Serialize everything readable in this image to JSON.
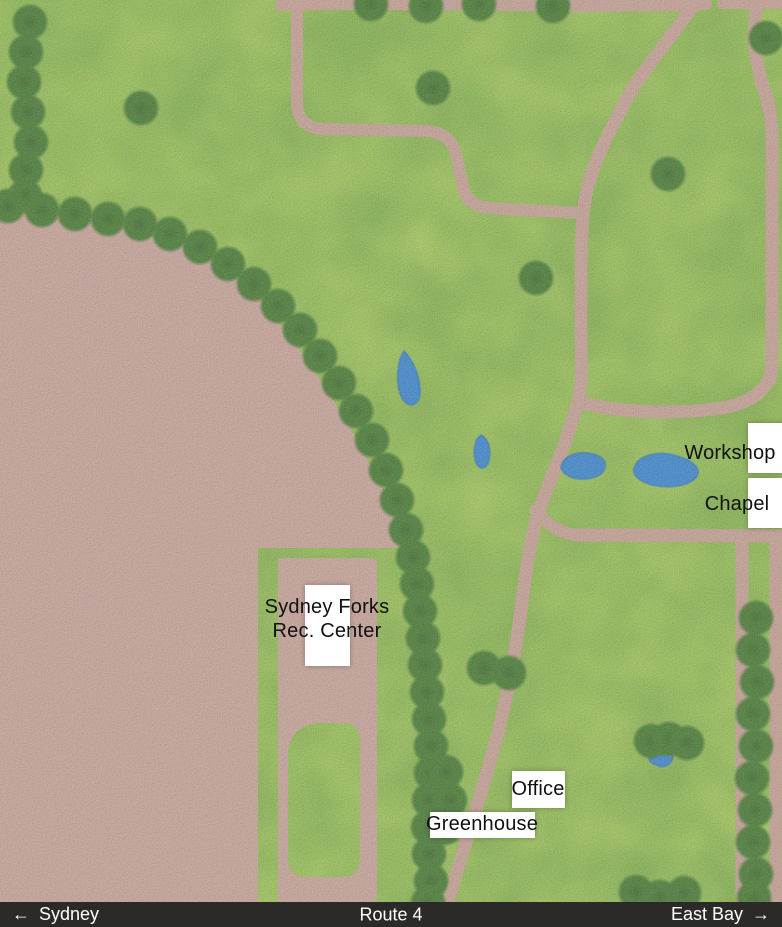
{
  "colors": {
    "grass": "#76ac35",
    "grass_light": "#8cc14b",
    "dirt": "#c59a8d",
    "path": "#c29688",
    "tree": "#2e6a15",
    "tree_dark": "#24570d",
    "water": "#2178cd",
    "water_dark": "#1865b5",
    "bar_bg": "#2b2a28",
    "bar_text": "#ffffff",
    "label_bg": "#ffffff",
    "label_text": "#101010"
  },
  "map": {
    "labels": {
      "workshop": "Workshop",
      "chapel": "Chapel",
      "rec_center_line1": "Sydney Forks",
      "rec_center_line2": "Rec. Center",
      "office": "Office",
      "greenhouse": "Greenhouse"
    }
  },
  "nav": {
    "west": {
      "arrow": "←",
      "label": "Sydney"
    },
    "center": {
      "label": "Route 4"
    },
    "east": {
      "label": "East Bay",
      "arrow": "→"
    }
  }
}
